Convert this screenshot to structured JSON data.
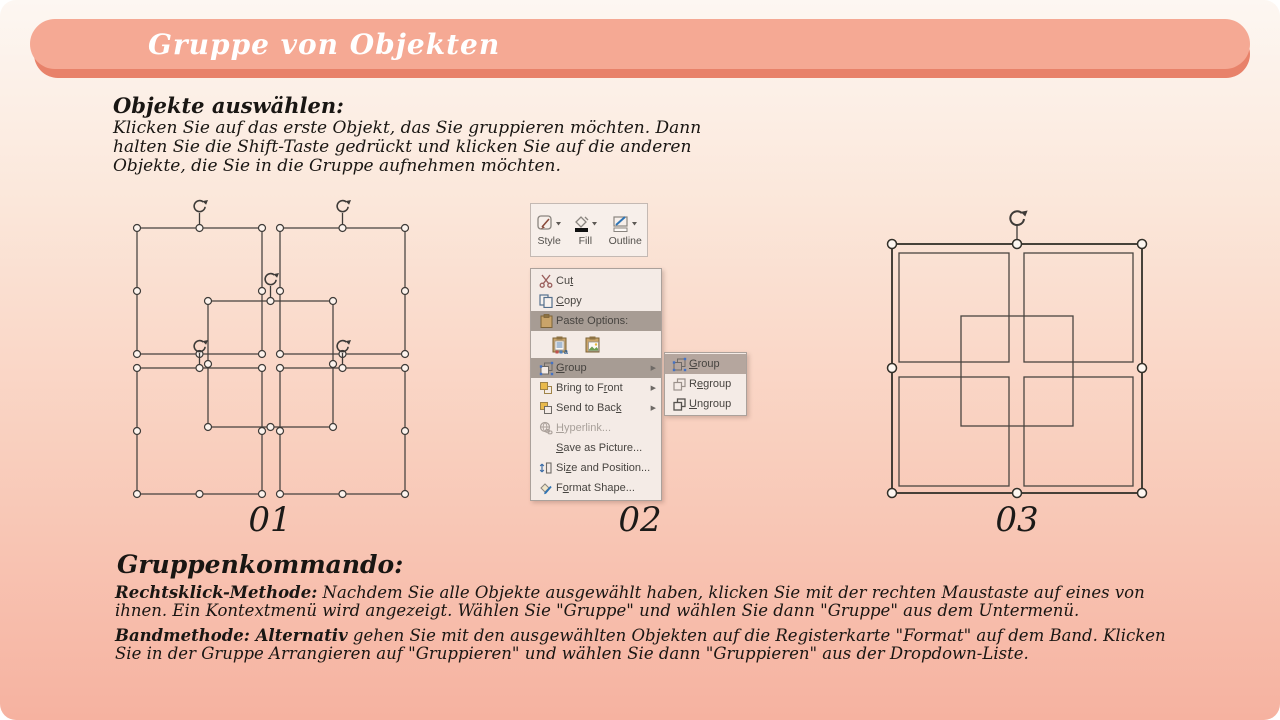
{
  "title": "Gruppe von Objekten",
  "section1": {
    "heading": "Objekte auswählen:",
    "lines": [
      "Klicken Sie auf das erste Objekt, das Sie gruppieren möchten. Dann",
      "halten Sie die Shift-Taste gedrückt und klicken Sie auf die anderen",
      "Objekte, die Sie in die Gruppe aufnehmen möchten."
    ]
  },
  "figure_labels": {
    "fig1": "01",
    "fig2": "02",
    "fig3": "03"
  },
  "mini_toolbar": {
    "style": "Style",
    "fill": "Fill",
    "outline": "Outline"
  },
  "context_menu": {
    "cut": {
      "pre": "Cu",
      "u": "t",
      "post": ""
    },
    "copy": {
      "pre": "",
      "u": "C",
      "post": "opy"
    },
    "paste_options": {
      "pre": "Paste Options:",
      "u": "",
      "post": ""
    },
    "group": {
      "pre": "",
      "u": "G",
      "post": "roup"
    },
    "bring_to_front": {
      "pre": "Bring to F",
      "u": "r",
      "post": "ont"
    },
    "send_to_back": {
      "pre": "Send to Bac",
      "u": "k",
      "post": ""
    },
    "hyperlink": {
      "pre": "",
      "u": "H",
      "post": "yperlink..."
    },
    "save_as_picture": {
      "pre": "",
      "u": "S",
      "post": "ave as Picture..."
    },
    "size_and_position": {
      "pre": "Si",
      "u": "z",
      "post": "e and Position..."
    },
    "format_shape": {
      "pre": "F",
      "u": "o",
      "post": "rmat Shape..."
    }
  },
  "group_submenu": {
    "group": {
      "pre": "",
      "u": "G",
      "post": "roup"
    },
    "regroup": {
      "pre": "R",
      "u": "e",
      "post": "group"
    },
    "ungroup": {
      "pre": "",
      "u": "U",
      "post": "ngroup"
    }
  },
  "section2": {
    "heading": "Gruppenkommando:",
    "para1_lead": "Rechtsklick-Methode:",
    "para1_text": " Nachdem Sie alle Objekte ausgewählt haben, klicken Sie mit der rechten Maustaste auf eines von ihnen. Ein Kontextmenü wird angezeigt. Wählen Sie \"Gruppe\" und wählen Sie dann \"Gruppe\" aus dem Untermenü.",
    "para2_lead": "Bandmethode: Alternativ",
    "para2_text": " gehen Sie mit den ausgewählten Objekten auf die Registerkarte \"Format\" auf dem Band. Klicken Sie in der Gruppe Arrangieren auf \"Gruppieren\" und wählen Sie dann \"Gruppieren\" aus der Dropdown-Liste."
  },
  "colors": {
    "banner": "#F5A994",
    "banner_shadow": "#E8826A",
    "background_top": "#FDF7F2",
    "background_bottom": "#F6B1A0",
    "menu_highlight": "#A79C94",
    "submenu_highlight": "#B5A69E",
    "icon_blue": "#3F6FA8"
  }
}
